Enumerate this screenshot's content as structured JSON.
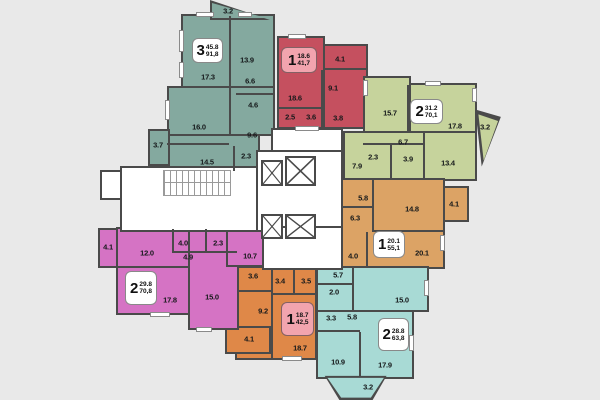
{
  "plan": {
    "title": "apartment-floor-plan",
    "colors": {
      "background": "#e9e9e9",
      "wall": "#4a4a4a",
      "core_white": "#ffffff",
      "label_box_highlight": "#f2a4ae"
    },
    "apartments": [
      {
        "name": "teal-3-room",
        "number": "3",
        "living": "45.8",
        "total": "91,8",
        "color": "#84a99f",
        "label_fill": "#ffffff",
        "rooms": [
          {
            "a": "3.2",
            "x": 228,
            "y": 11
          },
          {
            "a": "17.3",
            "x": 208,
            "y": 77
          },
          {
            "a": "13.9",
            "x": 247,
            "y": 60
          },
          {
            "a": "6.6",
            "x": 250,
            "y": 81
          },
          {
            "a": "4.6",
            "x": 253,
            "y": 105
          },
          {
            "a": "16.0",
            "x": 199,
            "y": 127
          },
          {
            "a": "9.6",
            "x": 252,
            "y": 135
          },
          {
            "a": "3.7",
            "x": 158,
            "y": 145
          },
          {
            "a": "14.5",
            "x": 207,
            "y": 162
          },
          {
            "a": "2.3",
            "x": 246,
            "y": 156
          }
        ]
      },
      {
        "name": "red-1-room",
        "number": "1",
        "living": "18.6",
        "total": "41,7",
        "color": "#c5505f",
        "label_fill": "#f2a4ae",
        "rooms": [
          {
            "a": "4.1",
            "x": 340,
            "y": 59
          },
          {
            "a": "9.1",
            "x": 333,
            "y": 88
          },
          {
            "a": "18.6",
            "x": 295,
            "y": 98
          },
          {
            "a": "2.5",
            "x": 290,
            "y": 117
          },
          {
            "a": "3.6",
            "x": 311,
            "y": 117
          },
          {
            "a": "3.8",
            "x": 338,
            "y": 118
          }
        ]
      },
      {
        "name": "green-2-room",
        "number": "2",
        "living": "31.2",
        "total": "70,1",
        "color": "#c6d39c",
        "label_fill": "#ffffff",
        "rooms": [
          {
            "a": "15.7",
            "x": 390,
            "y": 113
          },
          {
            "a": "17.8",
            "x": 455,
            "y": 126
          },
          {
            "a": "3.2",
            "x": 485,
            "y": 127
          },
          {
            "a": "6.7",
            "x": 403,
            "y": 142
          },
          {
            "a": "2.3",
            "x": 373,
            "y": 157
          },
          {
            "a": "3.9",
            "x": 408,
            "y": 159
          },
          {
            "a": "7.9",
            "x": 357,
            "y": 166
          },
          {
            "a": "13.4",
            "x": 448,
            "y": 163
          }
        ]
      },
      {
        "name": "orange-1-room-mid",
        "number": "1",
        "living": "20.1",
        "total": "55,1",
        "color": "#dca365",
        "label_fill": "#ffffff",
        "rooms": [
          {
            "a": "5.8",
            "x": 363,
            "y": 198
          },
          {
            "a": "14.8",
            "x": 412,
            "y": 209
          },
          {
            "a": "4.1",
            "x": 454,
            "y": 204
          },
          {
            "a": "6.3",
            "x": 355,
            "y": 218
          },
          {
            "a": "4.0",
            "x": 353,
            "y": 256
          },
          {
            "a": "20.1",
            "x": 422,
            "y": 253
          }
        ]
      },
      {
        "name": "cyan-2-room",
        "number": "2",
        "living": "28.8",
        "total": "63,8",
        "color": "#a8dad5",
        "label_fill": "#ffffff",
        "rooms": [
          {
            "a": "5.7",
            "x": 338,
            "y": 275
          },
          {
            "a": "2.0",
            "x": 334,
            "y": 292
          },
          {
            "a": "15.0",
            "x": 402,
            "y": 300
          },
          {
            "a": "3.3",
            "x": 331,
            "y": 318
          },
          {
            "a": "5.8",
            "x": 352,
            "y": 317
          },
          {
            "a": "10.9",
            "x": 338,
            "y": 362
          },
          {
            "a": "17.9",
            "x": 385,
            "y": 365
          },
          {
            "a": "3.2",
            "x": 368,
            "y": 387
          }
        ]
      },
      {
        "name": "orange-1-room-bottom",
        "number": "1",
        "living": "18.7",
        "total": "42,5",
        "color": "#df8848",
        "label_fill": "#f2a4ae",
        "rooms": [
          {
            "a": "3.6",
            "x": 253,
            "y": 276
          },
          {
            "a": "3.4",
            "x": 280,
            "y": 281
          },
          {
            "a": "3.5",
            "x": 306,
            "y": 281
          },
          {
            "a": "9.2",
            "x": 263,
            "y": 311
          },
          {
            "a": "4.1",
            "x": 249,
            "y": 339
          },
          {
            "a": "18.7",
            "x": 300,
            "y": 348
          }
        ]
      },
      {
        "name": "pink-2-room",
        "number": "2",
        "living": "29.8",
        "total": "70,8",
        "color": "#d573c4",
        "label_fill": "#ffffff",
        "rooms": [
          {
            "a": "4.1",
            "x": 108,
            "y": 247
          },
          {
            "a": "12.0",
            "x": 147,
            "y": 253
          },
          {
            "a": "4.0",
            "x": 183,
            "y": 243
          },
          {
            "a": "2.3",
            "x": 218,
            "y": 243
          },
          {
            "a": "4.9",
            "x": 188,
            "y": 257
          },
          {
            "a": "10.7",
            "x": 250,
            "y": 256
          },
          {
            "a": "17.8",
            "x": 170,
            "y": 300
          },
          {
            "a": "15.0",
            "x": 212,
            "y": 297
          }
        ]
      }
    ]
  }
}
